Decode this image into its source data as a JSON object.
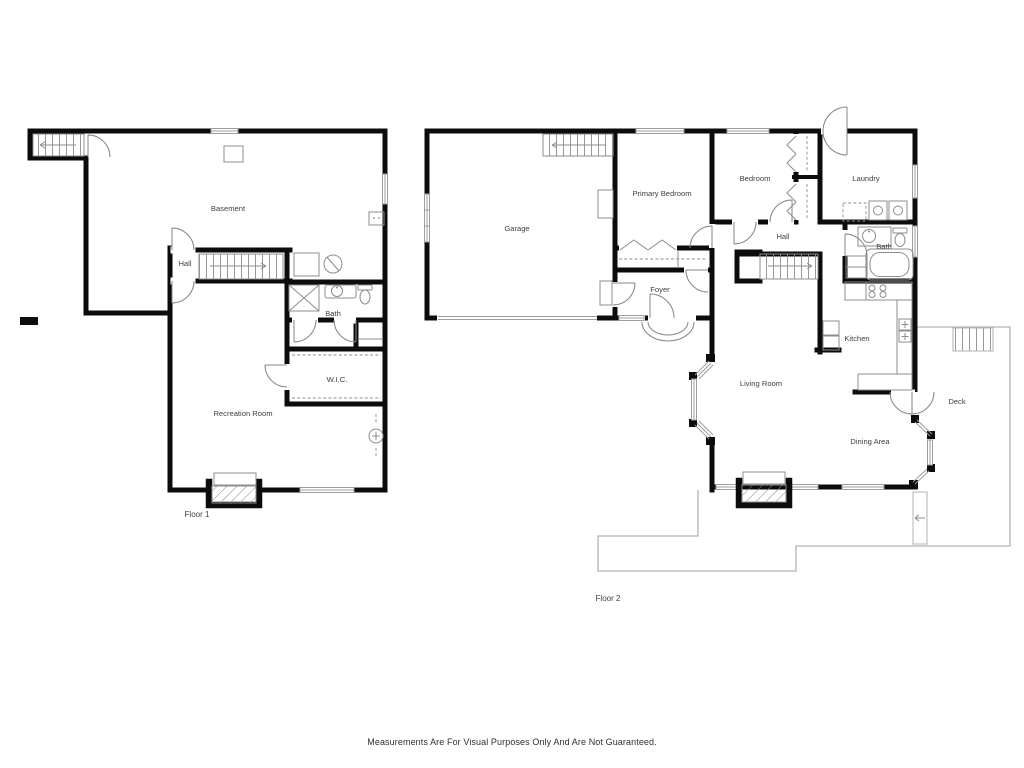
{
  "disclaimer": "Measurements Are For Visual Purposes Only And Are Not Guaranteed.",
  "floor1": {
    "name": "Floor 1",
    "rooms": {
      "basement": "Basement",
      "hall": "Hall",
      "bath": "Bath",
      "wic": "W.I.C.",
      "recreation_room": "Recreation Room"
    }
  },
  "floor2": {
    "name": "Floor 2",
    "rooms": {
      "garage": "Garage",
      "primary_bedroom": "Primary Bedroom",
      "bedroom": "Bedroom",
      "laundry": "Laundry",
      "hall": "Hall",
      "foyer": "Foyer",
      "bath": "Bath",
      "kitchen": "Kitchen",
      "living_room": "Living Room",
      "dining_area": "Dining Area",
      "deck": "Deck"
    }
  },
  "colors": {
    "wall": "#0c0c0c",
    "thin_line": "#8d8d8d",
    "outline": "#b3b3b3",
    "label": "#3e3e3e",
    "background": "#ffffff"
  }
}
